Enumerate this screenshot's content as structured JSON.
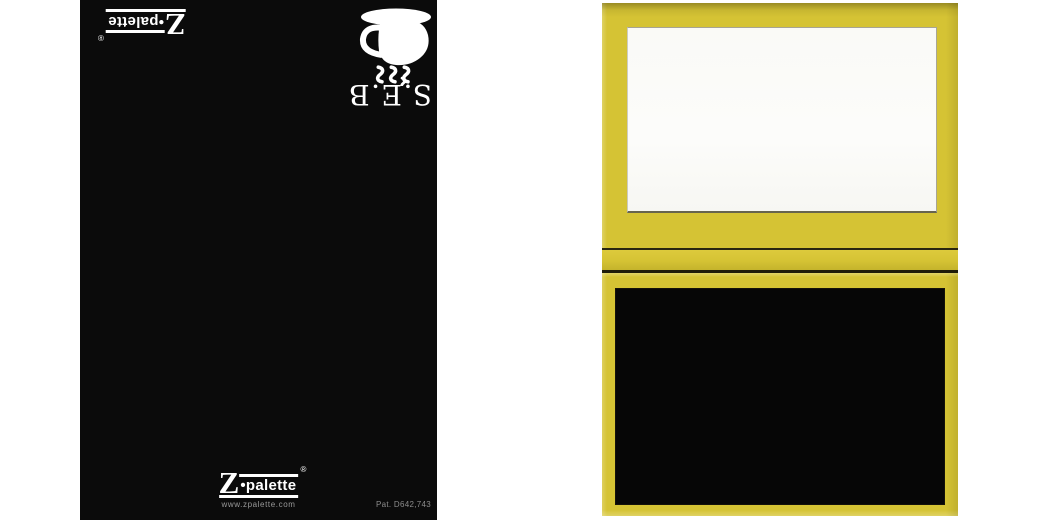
{
  "scene": {
    "background_color": "#ffffff"
  },
  "brand": {
    "z": "Z",
    "bullet": "•",
    "name": "palette",
    "reg": "®"
  },
  "black_palette": {
    "surface_color": "#0b0b0b",
    "monogram": "S.E.B",
    "website": "www.zpalette.com",
    "patent": "Pat. D642,743",
    "cup_icon": "coffee-cup-with-saucer-and-steam-icon",
    "text_color_logo": "#ffffff",
    "text_color_small": "#9a9a9a"
  },
  "yellow_palette": {
    "shell_color": "#d5c334",
    "lid_panel_color": "#fbfbf8",
    "base_panel_color": "#060606",
    "seam_color": "#2a2610"
  }
}
